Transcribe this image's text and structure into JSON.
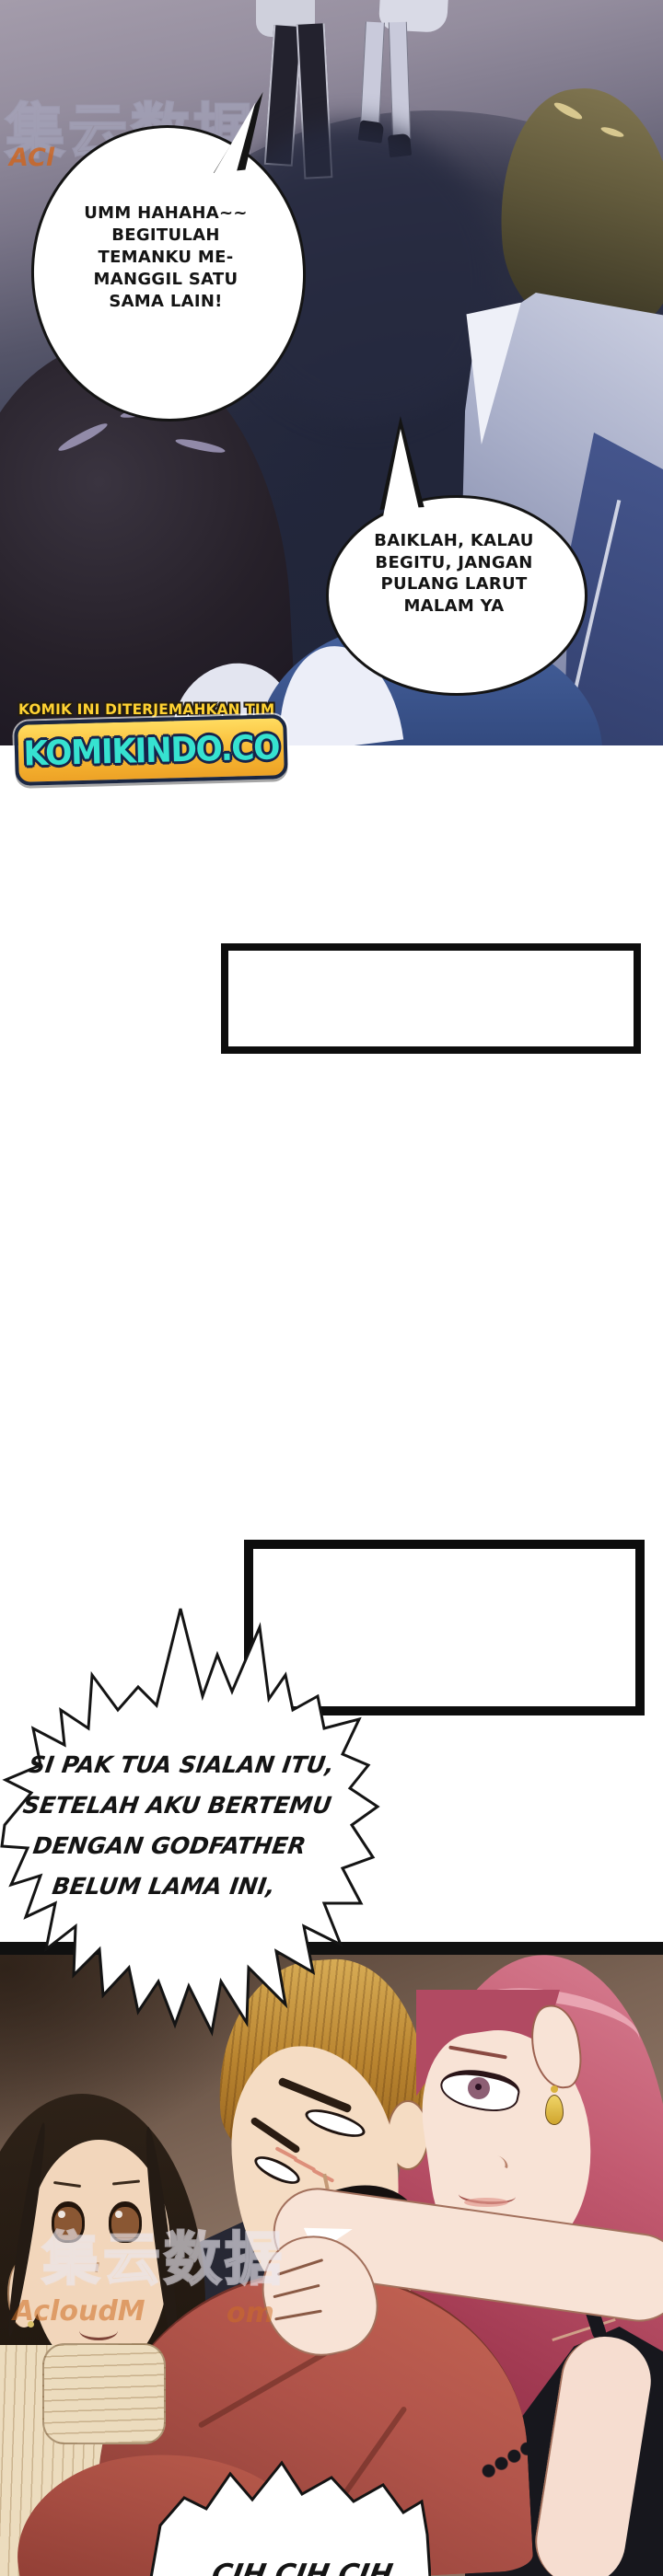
{
  "page": {
    "kind": "translated webtoon comic page",
    "language": "Indonesian"
  },
  "panel_street": {
    "watermark_cjk": "集云数据",
    "watermark_latin_fragment": "ACl",
    "bubble_laugh": {
      "lines": [
        "UMM HAHAHA~~",
        "BEGITULAH",
        "TEMANKU ME-",
        "MANGGIL SATU",
        "SAMA LAIN!"
      ]
    },
    "bubble_reply": {
      "lines": [
        "BAIKLAH, KALAU",
        "BEGITU, JANGAN",
        "PULANG LARUT",
        "MALAM YA"
      ]
    }
  },
  "translator_banner": {
    "tagline": "KOMIK INI DITERJEMAHKAN TIM",
    "site_name": "KOMIKINDO.CO",
    "tagline_color": "#ffd232",
    "site_text_color": "#36e2d0",
    "plate_color": "#f8b833",
    "outline_color": "#16234a"
  },
  "gap_section": {
    "bubble_shout": {
      "lines": [
        "SI PAK TUA SIALAN ITU,",
        "SETELAH AKU BERTEMU",
        "DENGAN GODFATHER",
        "BELUM LAMA INI,"
      ]
    }
  },
  "panel_hug": {
    "watermark_cjk": "集云数据",
    "watermark_latin_fragment_left": "AcloudM",
    "watermark_latin_fragment_right": "om",
    "bubble_scoff": "CIH CIH CIH"
  }
}
